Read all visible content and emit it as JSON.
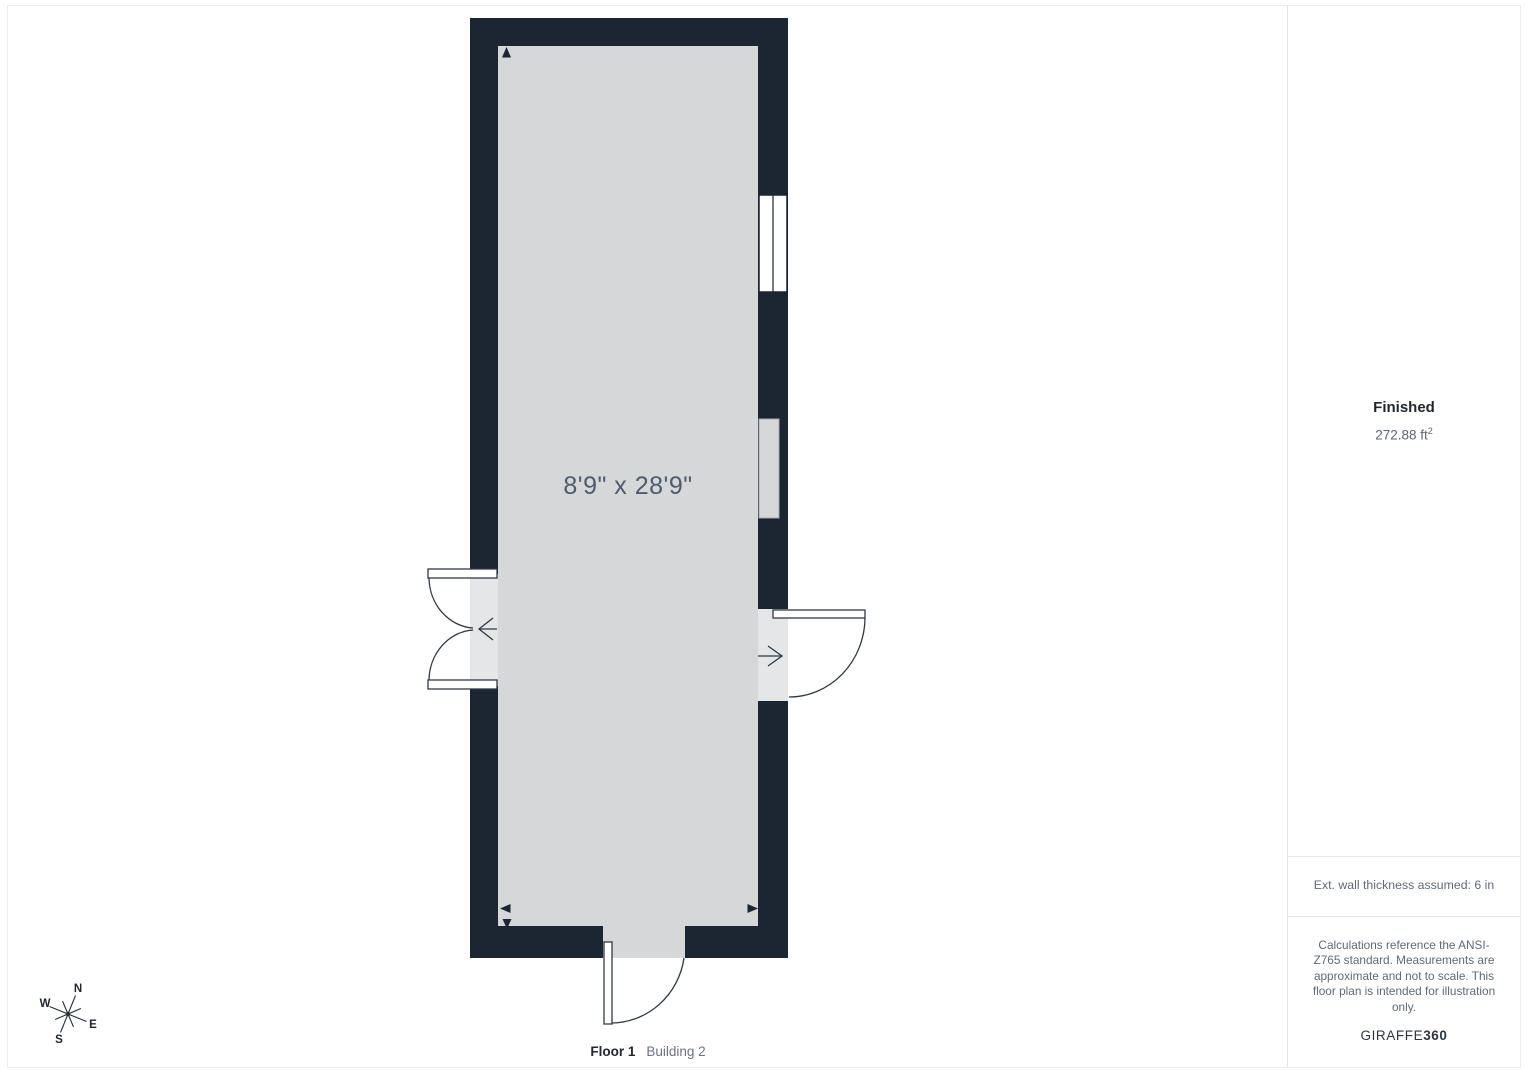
{
  "plan": {
    "room_dimension_label": "8'9\" x 28'9\"",
    "floor_label": "Floor 1",
    "building_label": "Building 2",
    "wall_color": "#1c2532",
    "floor_color": "#d6d7d8"
  },
  "compass": {
    "north": "N",
    "east": "E",
    "south": "S",
    "west": "W"
  },
  "sidebar": {
    "status_title": "Finished",
    "area_value": "272.88 ft",
    "area_superscript": "2",
    "wall_note": "Ext. wall thickness assumed: 6 in",
    "disclaimer": "Calculations reference the ANSI-Z765 standard. Measurements are approximate and not to scale. This floor plan is intended for illustration only.",
    "brand_name": "GIRAFFE",
    "brand_suffix": "360"
  }
}
